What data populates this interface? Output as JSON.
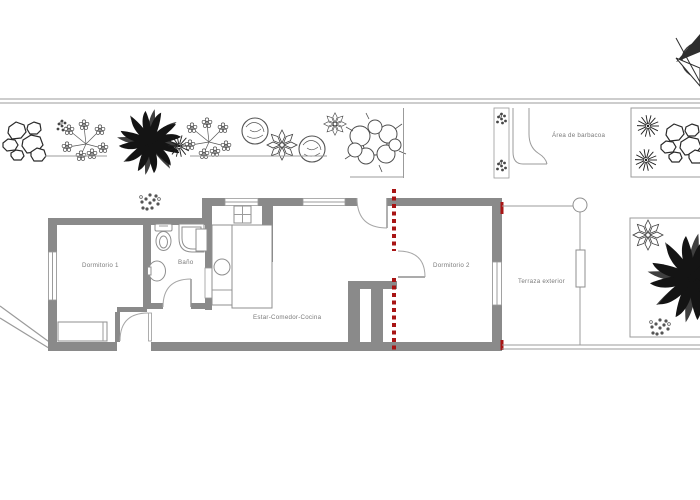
{
  "plan": {
    "labels": {
      "bedroom1": "Dormitorio 1",
      "bathroom": "Baño",
      "living": "Estar-Comedor-Cocina",
      "bedroom2": "Dormitorio 2",
      "terrace": "Terraza exterior",
      "bbq": "Área de barbacoa"
    },
    "colors": {
      "wall_gray": "#8a8a8a",
      "thin_line_gray": "#9b9b9b",
      "accent_red": "#a81414",
      "label_text": "#7a7a7a",
      "plant_dark": "#141414"
    },
    "icons": [
      "north-arrow-compass-icon",
      "palm-tree-icon",
      "shrub-icon",
      "rock-cluster-icon",
      "flower-branch-icon",
      "round-bush-icon",
      "star-flower-icon",
      "starburst-plant-icon",
      "dot-plant-icon",
      "toilet-icon",
      "shower-icon",
      "sink-icon",
      "stove-icon",
      "kitchen-island",
      "wardrobe",
      "terrace-column"
    ]
  }
}
